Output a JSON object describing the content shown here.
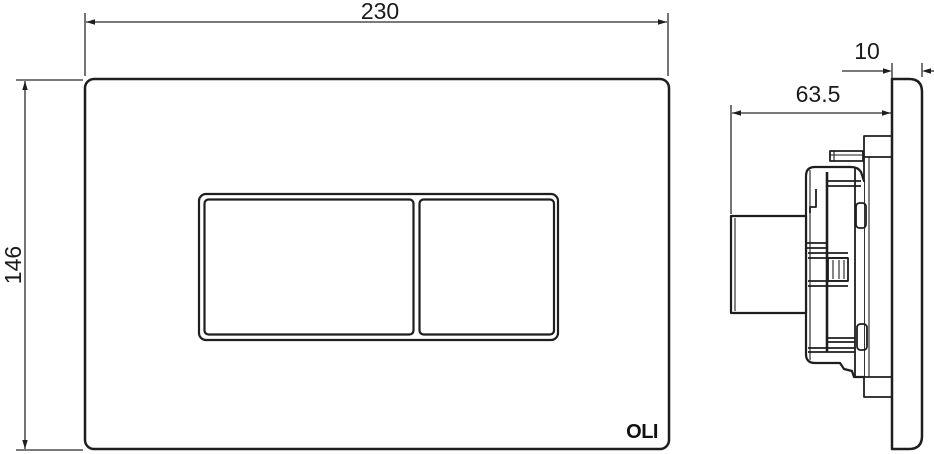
{
  "drawing": {
    "type": "technical-dimension-drawing",
    "logo_text": "OLI",
    "dimensions": {
      "front_width": "230",
      "front_height": "146",
      "side_depth": "63.5",
      "side_plate_thickness": "10"
    },
    "colors": {
      "outline": "#1e1e1e",
      "dimension_line": "#2b2b2b",
      "text": "#1a1a1a",
      "background": "#ffffff"
    }
  }
}
